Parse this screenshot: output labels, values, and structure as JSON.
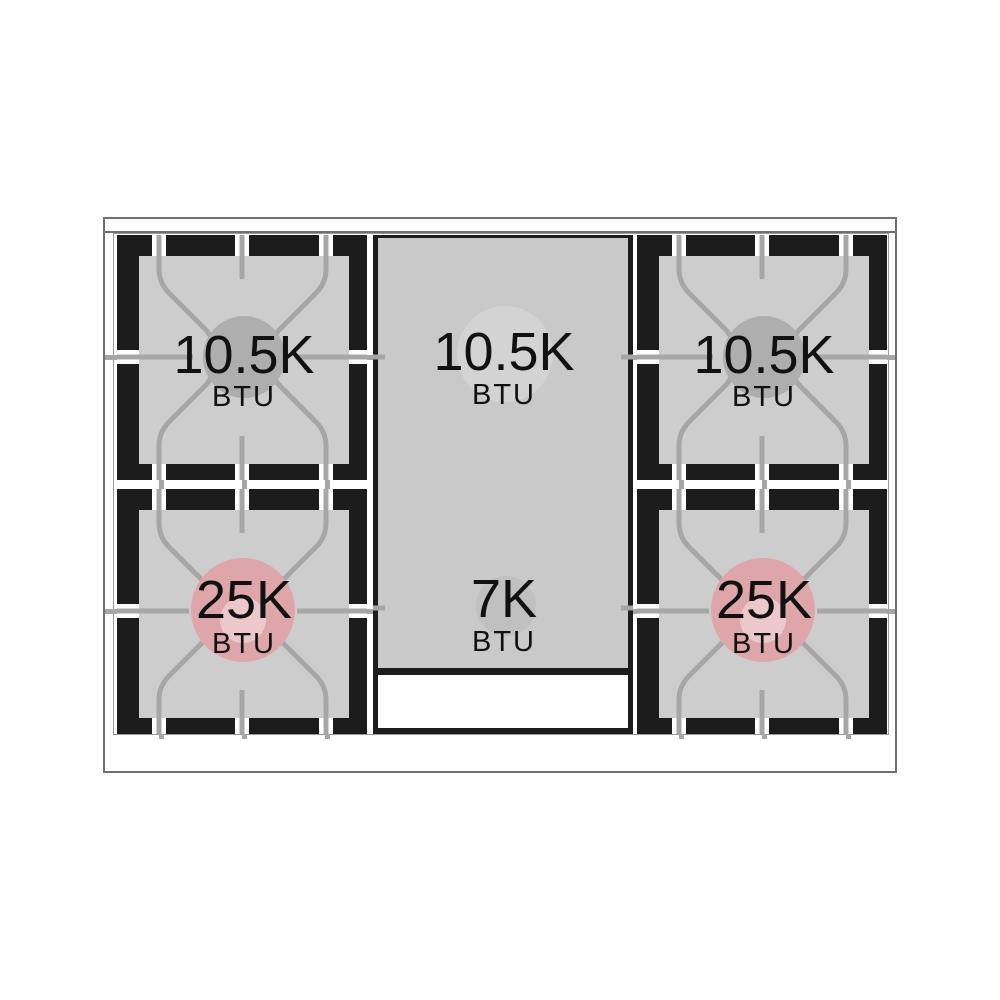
{
  "burners": {
    "top_left": {
      "value": "10.5K",
      "unit": "BTU"
    },
    "top_center": {
      "value": "10.5K",
      "unit": "BTU"
    },
    "top_right": {
      "value": "10.5K",
      "unit": "BTU"
    },
    "bottom_left": {
      "value": "25K",
      "unit": "BTU"
    },
    "bottom_center": {
      "value": "7K",
      "unit": "BTU"
    },
    "bottom_right": {
      "value": "25K",
      "unit": "BTU"
    }
  },
  "colors": {
    "grate_black": "#1c1c1c",
    "burner_square_gray": "#cdcdcd",
    "column_gray": "#c9c9c9",
    "grate_line_gray": "#a6a6a6",
    "cap_gray": "#aeaeae",
    "cap_light_gray": "#d3d3d3",
    "cap_mid_gray": "#c0c0c0",
    "flame_pink": "#dfa6aa",
    "flame_pink_inner": "#ecc8ca",
    "text_black": "#111111"
  }
}
